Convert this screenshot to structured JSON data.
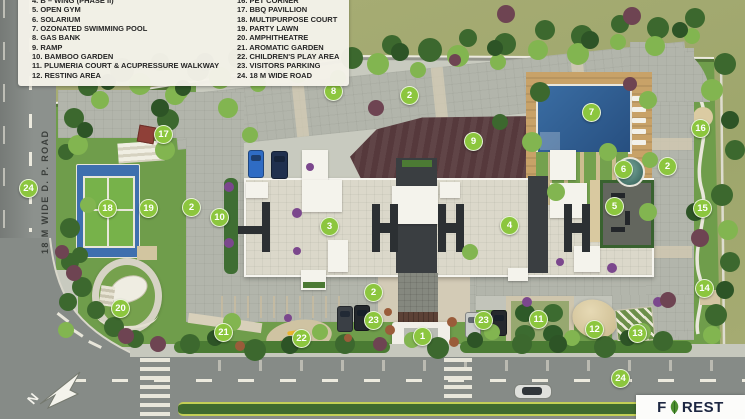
{
  "legend": {
    "items_left": [
      "4.  B – WING (PHASE II)",
      "5.  OPEN GYM",
      "6.  SOLARIUM",
      "7.  OZONATED SWIMMING POOL",
      "8.  GAS BANK",
      "9.  RAMP",
      "10. BAMBOO GARDEN",
      "11. PLUMERIA COURT & ACUPRESSURE WALKWAY",
      "12. RESTING AREA"
    ],
    "items_right": [
      "16. PET CORNER",
      "17. BBQ PAVILLION",
      "18. MULTIPURPOSE COURT",
      "19. PARTY LAWN",
      "20. AMPHITHEATRE",
      "21. AROMATIC GARDEN",
      "22. CHILDREN'S PLAY AREA",
      "23. VISITORS PARKING",
      "24. 18 M WIDE ROAD"
    ]
  },
  "road_label_left": "18 M WIDE D. P. ROAD",
  "compass_letter": "N",
  "logo": {
    "f": "F",
    "rest": "REST"
  },
  "markers": [
    {
      "n": "1",
      "x": 422,
      "y": 336
    },
    {
      "n": "2",
      "x": 409,
      "y": 95
    },
    {
      "n": "2",
      "x": 191,
      "y": 207
    },
    {
      "n": "2",
      "x": 667,
      "y": 166
    },
    {
      "n": "2",
      "x": 373,
      "y": 292
    },
    {
      "n": "3",
      "x": 329,
      "y": 226
    },
    {
      "n": "4",
      "x": 509,
      "y": 225
    },
    {
      "n": "5",
      "x": 614,
      "y": 206
    },
    {
      "n": "6",
      "x": 623,
      "y": 169
    },
    {
      "n": "7",
      "x": 591,
      "y": 112
    },
    {
      "n": "8",
      "x": 333,
      "y": 91
    },
    {
      "n": "9",
      "x": 473,
      "y": 141
    },
    {
      "n": "10",
      "x": 219,
      "y": 217
    },
    {
      "n": "11",
      "x": 538,
      "y": 319
    },
    {
      "n": "12",
      "x": 594,
      "y": 329
    },
    {
      "n": "13",
      "x": 637,
      "y": 333
    },
    {
      "n": "14",
      "x": 704,
      "y": 288
    },
    {
      "n": "15",
      "x": 702,
      "y": 208
    },
    {
      "n": "16",
      "x": 700,
      "y": 128
    },
    {
      "n": "17",
      "x": 163,
      "y": 134
    },
    {
      "n": "18",
      "x": 107,
      "y": 208
    },
    {
      "n": "19",
      "x": 148,
      "y": 208
    },
    {
      "n": "20",
      "x": 120,
      "y": 308
    },
    {
      "n": "21",
      "x": 223,
      "y": 332
    },
    {
      "n": "22",
      "x": 301,
      "y": 338
    },
    {
      "n": "23",
      "x": 373,
      "y": 320
    },
    {
      "n": "23",
      "x": 483,
      "y": 320
    },
    {
      "n": "24",
      "x": 28,
      "y": 188
    },
    {
      "n": "24",
      "x": 620,
      "y": 378
    }
  ],
  "colors": {
    "marker_green": "#8cc63e",
    "pool_blue": "#2e5f95",
    "court_blue": "#3e6fae",
    "court_green": "#77b24a",
    "ramp_brown": "#56393c",
    "road_gray": "#868b87",
    "building": "#dbd8ca",
    "lawn_green": "#6f9d4b",
    "exterior_grass": "#a5ab74",
    "logo_navy": "#1d2742",
    "leaf_green": "#4e8f2f"
  }
}
